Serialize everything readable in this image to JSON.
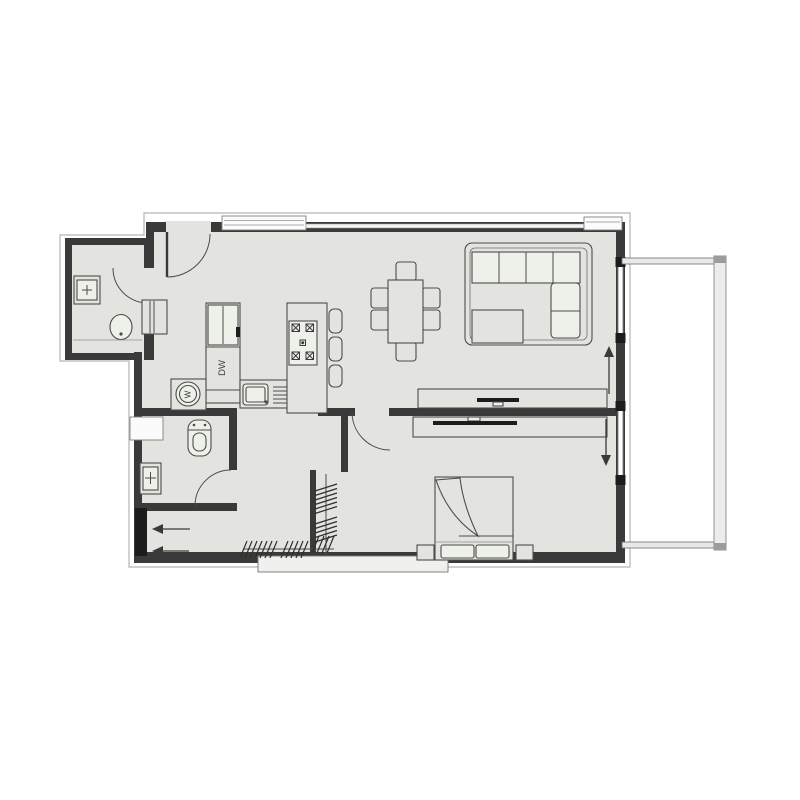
{
  "drawing": {
    "type": "apartment-floor-plan",
    "labels": {
      "dishwasher": "DW",
      "washer_glyph": "W"
    },
    "colors": {
      "background": "#ffffff",
      "floor": "#e3e4df",
      "wall": "#3a3a3a",
      "furniture_line": "#4c4c4c",
      "window": "#fbfbfb",
      "balcony_rail": "#ececec",
      "entry_door": "#1c1c1c"
    },
    "inventory": {
      "bathrooms": 2,
      "toilets": 2,
      "vanity_sinks": 2,
      "washing_machine": 1,
      "refrigerator": 1,
      "dishwasher": 1,
      "kitchen_sink": 1,
      "cooktop_burners": 4,
      "bar_stools": 3,
      "dining_table": 1,
      "dining_chairs": 6,
      "sectional_sofa": 1,
      "coffee_table": 1,
      "media_consoles": 2,
      "tvs": 2,
      "double_bed": 1,
      "nightstands": 2,
      "closet_rods": 2,
      "door_swings": 5,
      "entry_arrows": 2,
      "slide_arrow_up": 1,
      "slide_arrow_down": 1,
      "balcony": 1
    },
    "symbols": [
      "entry-door",
      "door-swing-arc",
      "toilet",
      "bathroom-vanity",
      "washing-machine",
      "refrigerator",
      "dishwasher-cabinet",
      "kitchen-sink-with-drainboard",
      "cooktop-island",
      "bar-stool",
      "dining-table",
      "dining-chair",
      "sectional-sofa",
      "coffee-table",
      "media-console",
      "tv",
      "double-bed",
      "nightstand",
      "closet-rod-with-hangers",
      "sliding-glass-door",
      "balcony-railing",
      "window",
      "direction-arrow"
    ]
  }
}
